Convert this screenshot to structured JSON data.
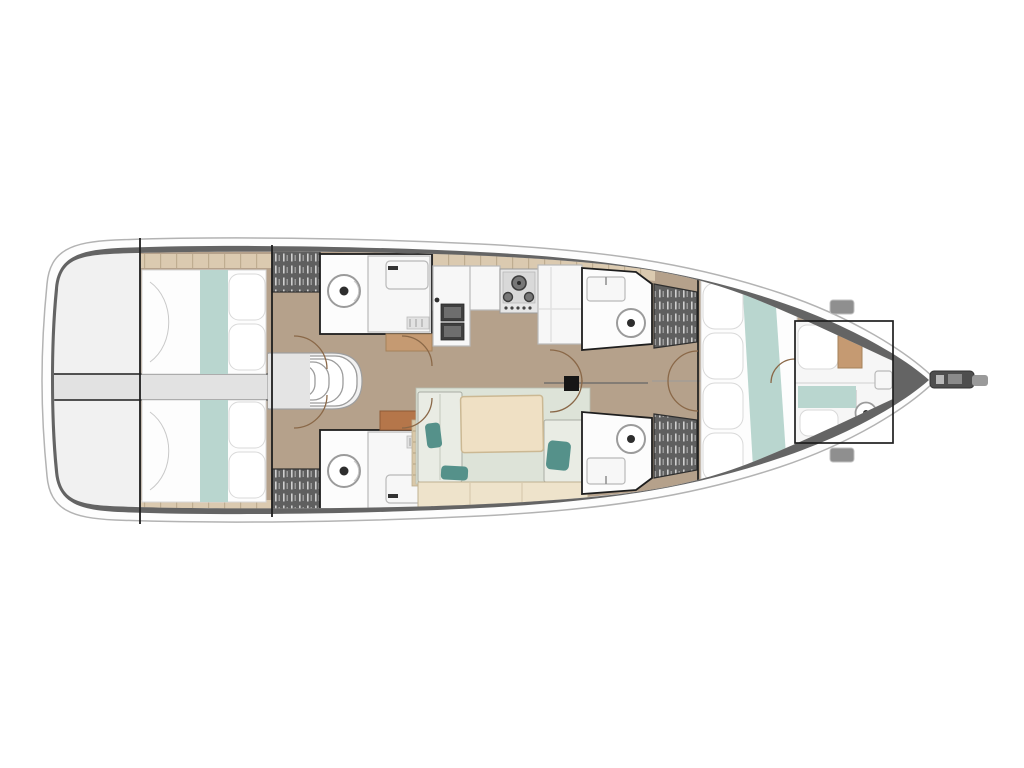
{
  "meta": {
    "description": "Top-down interior layout floor plan of a sailing yacht; bow points right, stern swim platform at left; no visible text labels in the drawing",
    "background": "#ffffff"
  },
  "colors": {
    "hull_band": "#646464",
    "hull_rim": "#fdfdfd",
    "floor_tan": "#b5a18b",
    "trim_beige": "#dbcab0",
    "blanket_teal": "#b9d6cf",
    "pillow_teal": "#55918a",
    "salon_floor": "#dde3d8",
    "seat_cushion": "#e9ece4",
    "table_wood": "#efe0c4",
    "bench": "#eee3cb",
    "cabinet_tan": "#c59a72",
    "cabinet_orange": "#b5764a",
    "wardrobe_dark": "#5f5f5f",
    "line_dark": "#1e1e1e",
    "door_arc": "#8a6848",
    "bowsprit_dark": "#4e4e4e",
    "bowsprit_tip": "#9a9a9a"
  },
  "rooms": {
    "hull": {
      "label": "Yacht hull outline, bow pointing right"
    },
    "swim_platform": {
      "label": "Stern transom swim platform"
    },
    "aft_cabin_top": {
      "label": "Aft double cabin with teal blanket and pillows (upper)"
    },
    "aft_cabin_bottom": {
      "label": "Aft double cabin with teal blanket and pillows (lower)"
    },
    "engine_compartment": {
      "label": "Engine compartment between aft cabins"
    },
    "companionway": {
      "label": "Companionway entry steps"
    },
    "aft_head_top": {
      "label": "Aft bathroom with toilet and sink (upper)"
    },
    "aft_head_bottom": {
      "label": "Aft bathroom with toilet and sink (lower)"
    },
    "galley": {
      "label": "Galley with double sink, stove and counters"
    },
    "salon": {
      "label": "Saloon seating area with table and teal cushions"
    },
    "mast": {
      "label": "Mast foot"
    },
    "mid_head_top": {
      "label": "Midship bathroom with sink and toilet (upper)"
    },
    "mid_head_bottom": {
      "label": "Midship bathroom with sink and toilet (lower)"
    },
    "wardrobe": {
      "label": "Hanging wardrobe locker"
    },
    "forward_cabin": {
      "label": "Forward double cabin with teal runner and pillows"
    },
    "forepeak": {
      "label": "Forepeak berth with small toilet and sink"
    },
    "bow": {
      "label": "Bow deck with anchor bowsprit"
    }
  }
}
